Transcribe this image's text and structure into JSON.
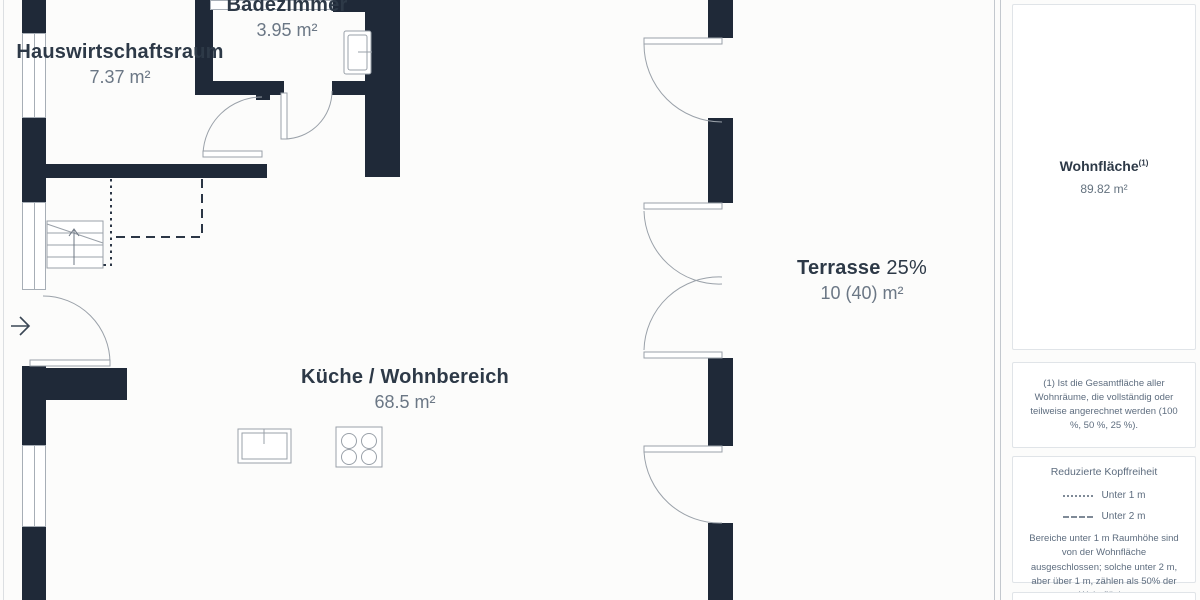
{
  "plan": {
    "rooms": {
      "badezimmer": {
        "name": "Badezimmer",
        "area": "3.95 m²"
      },
      "hauswirtschaftsraum": {
        "name": "Hauswirtschaftsraum",
        "area": "7.37 m²"
      },
      "kueche": {
        "name": "Küche / Wohnbereich",
        "area": "68.5 m²"
      },
      "terrasse": {
        "name": "Terrasse",
        "percent": "25%",
        "area": "10 (40) m²"
      }
    },
    "icons": {
      "entry_arrow": "right-arrow"
    }
  },
  "sidebar": {
    "summary": {
      "title": "Wohnfläche",
      "sup": "(1)",
      "value": "89.82 m²"
    },
    "footnote": "(1) Ist die Gesamtfläche aller Wohnräume, die vollständig oder teilweise angerechnet werden (100 %, 50 %, 25 %).",
    "legend": {
      "title": "Reduzierte Kopffreiheit",
      "items": [
        {
          "style": "dotted",
          "label": "Unter 1 m"
        },
        {
          "style": "dashed",
          "label": "Unter 2 m"
        }
      ],
      "note": "Bereiche unter 1 m Raumhöhe sind von der Wohnfläche ausgeschlossen; solche unter 2 m, aber über 1 m, zählen als 50% der Wohnfläche"
    }
  },
  "colors": {
    "wall": "#1f2938",
    "label": "#2d3947",
    "muted": "#6b7785",
    "line": "#9aa1a9",
    "card_border": "#e0e4e8"
  }
}
